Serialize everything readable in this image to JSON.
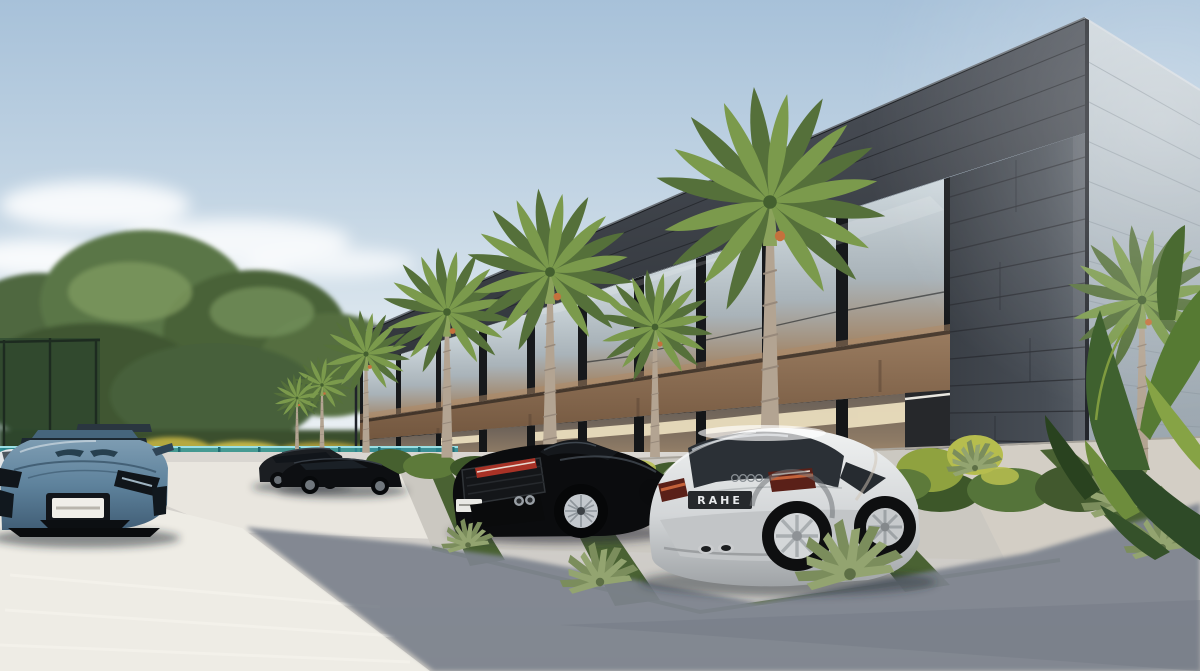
{
  "scene": {
    "image_type": "3d architectural visualization, exterior daylight",
    "setting": "Modern two-story commercial building with dark slate stone cladding, bronze spandrels and glass curtain walls; royal palms and tropical planting; luxury cars parked in front lot",
    "sky": {
      "top_color": "#a7c1d9",
      "horizon_color": "#eef2f5",
      "clouds": "soft scattered clouds, lower left"
    },
    "building": {
      "stories": 2,
      "cladding_color": "#3e434a",
      "spandrel_color": "#8a6e56",
      "glass_color": "#c2ccd2",
      "interior_light_color": "#efe3c2",
      "side_facade_color": "#b4bfc7"
    },
    "fence": {
      "type": "teal glass perimeter fence",
      "glass_color": "#2f95a0"
    },
    "vegetation": {
      "palms": 7,
      "palm_frond_color": "#7b9a4c",
      "hedge_colors": [
        "#3d5729",
        "#5d7a3a",
        "#b9c050"
      ],
      "background_trees_color": "#4f6840",
      "banana_plants": "right edge and building corner"
    },
    "ground": {
      "pavement_lit_color": "#eeece5",
      "pavement_shadow_color": "#7d838e",
      "parking_pad_color": "#cbc8c1",
      "grass_strip_color": "#4a6233"
    },
    "cars": [
      {
        "name": "blue supercar",
        "body_color": "#5e829c",
        "view": "front",
        "position": "far left foreground"
      },
      {
        "name": "white compact car",
        "body_color": "#e3e6e8",
        "view": "partial sliver",
        "position": "far left distance"
      },
      {
        "name": "black SUV",
        "body_color": "#1b1e22",
        "view": "side",
        "position": "mid-left"
      },
      {
        "name": "black coupe",
        "body_color": "#0d0f12",
        "view": "side",
        "position": "mid-left front"
      },
      {
        "name": "black supercar",
        "body_color": "#0b0c0e",
        "view": "rear three-quarter",
        "position": "center"
      },
      {
        "name": "white coupe",
        "body_color": "#e4e6e7",
        "view": "rear three-quarter",
        "position": "center right",
        "license_plate": "RAHE",
        "badge": "four rings"
      }
    ]
  }
}
